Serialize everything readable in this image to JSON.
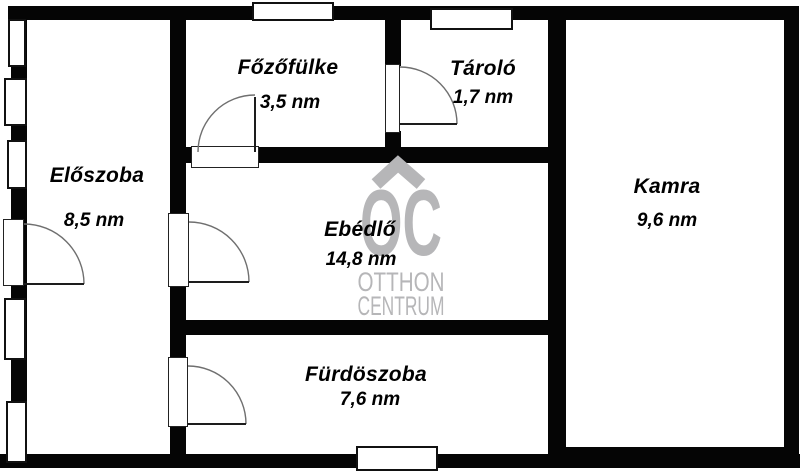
{
  "plan": {
    "background_color": "#ffffff",
    "wall_color": "#050505",
    "unit": "nm",
    "rooms": {
      "eloszoba": {
        "name": "Előszoba",
        "area": "8,5 nm"
      },
      "fozofulke": {
        "name": "Főzőfülke",
        "area": "3,5 nm"
      },
      "tarolo": {
        "name": "Tároló",
        "area": "1,7 nm"
      },
      "kamra": {
        "name": "Kamra",
        "area": "9,6 nm"
      },
      "ebedlo": {
        "name": "Ebédlő",
        "area": "14,8 nm"
      },
      "furdoszoba": {
        "name": "Fürdöszoba",
        "area": "7,6 nm"
      }
    },
    "watermark": {
      "logo_text": "OC",
      "line1": "OTTHON",
      "line2": "CENTRUM",
      "color": "#b6b6b8"
    }
  }
}
